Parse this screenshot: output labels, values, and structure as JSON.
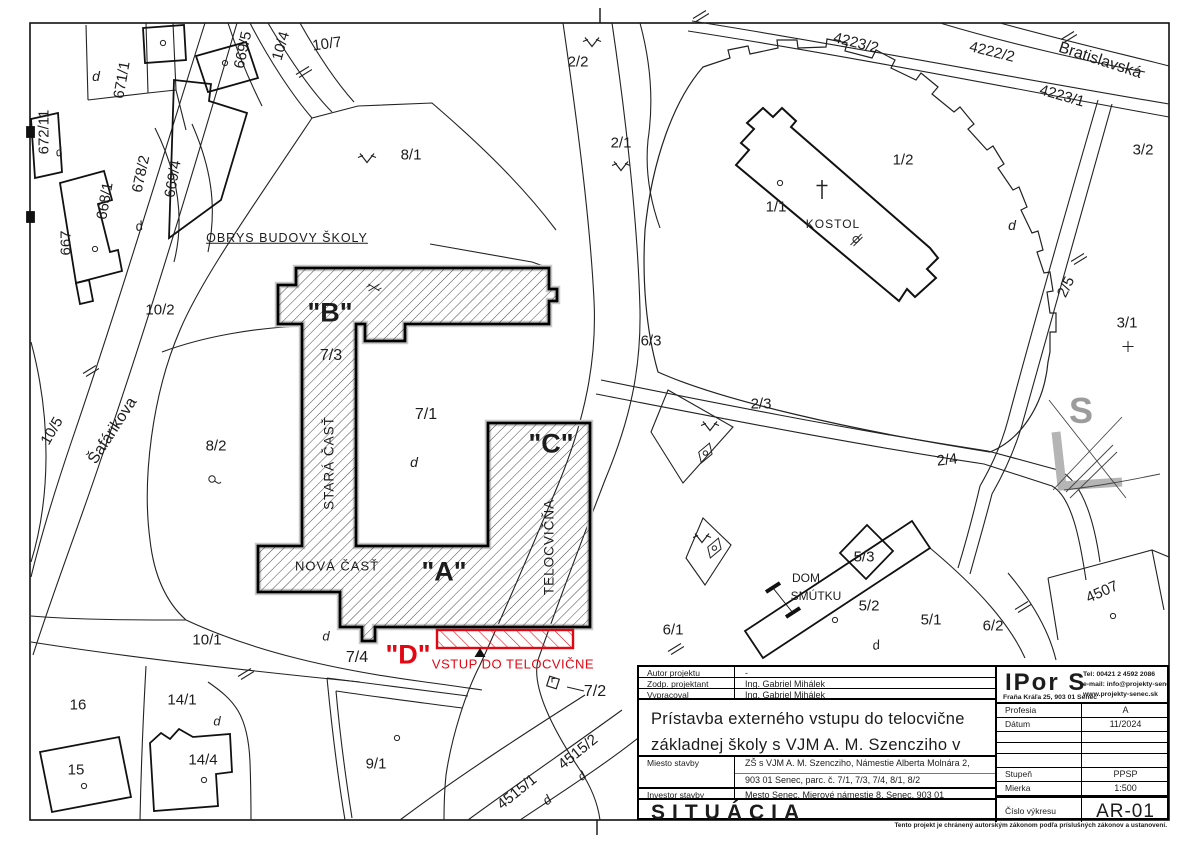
{
  "colors": {
    "accent_red": "#e30613",
    "north_gray": "#9c9c9c",
    "line": "#1c1c1c"
  },
  "map": {
    "labels": [
      {
        "t": "669/5",
        "x": 243,
        "y": 50,
        "r": -78
      },
      {
        "t": "10/4",
        "x": 281,
        "y": 46,
        "r": -74
      },
      {
        "t": "10/7",
        "x": 327,
        "y": 44,
        "r": -8
      },
      {
        "t": "671/1",
        "x": 122,
        "y": 80,
        "r": -80
      },
      {
        "t": "d",
        "x": 96,
        "y": 76,
        "i": 1,
        "s": 14
      },
      {
        "t": "672/11",
        "x": 44,
        "y": 132,
        "r": -90
      },
      {
        "t": "d",
        "x": 59,
        "y": 152,
        "i": 1,
        "s": 12,
        "r": -15
      },
      {
        "t": "678/2",
        "x": 141,
        "y": 174,
        "r": -78
      },
      {
        "t": "669/4",
        "x": 173,
        "y": 179,
        "r": -80
      },
      {
        "t": "668/1",
        "x": 105,
        "y": 201,
        "r": -80
      },
      {
        "t": "667",
        "x": 66,
        "y": 243,
        "r": -90
      },
      {
        "t": "d",
        "x": 139,
        "y": 226,
        "r": -15,
        "i": 1,
        "s": 13
      },
      {
        "t": "OBRYS BUDOVY ŠKOLY",
        "x": 287,
        "y": 238,
        "s": 12.5,
        "u": 1,
        "ls": 1,
        "n": "school-outline-callout"
      },
      {
        "t": "8/1",
        "x": 411,
        "y": 155
      },
      {
        "t": "2/2",
        "x": 578,
        "y": 62
      },
      {
        "t": "2/1",
        "x": 621,
        "y": 143
      },
      {
        "t": "1/1",
        "x": 776,
        "y": 207
      },
      {
        "t": "KOSTOL",
        "x": 833,
        "y": 224,
        "s": 12,
        "ls": 1,
        "n": "church-label"
      },
      {
        "t": "1/2",
        "x": 903,
        "y": 160
      },
      {
        "t": "4223/2",
        "x": 856,
        "y": 43,
        "r": 14
      },
      {
        "t": "4222/2",
        "x": 992,
        "y": 52,
        "r": 14
      },
      {
        "t": "Bratislavská",
        "x": 1100,
        "y": 61,
        "r": 18,
        "s": 16,
        "n": "street-bratislavska"
      },
      {
        "t": "4223/1",
        "x": 1062,
        "y": 96,
        "r": 16
      },
      {
        "t": "3/2",
        "x": 1143,
        "y": 150
      },
      {
        "t": "2/5",
        "x": 1066,
        "y": 287,
        "r": -64
      },
      {
        "t": "3/1",
        "x": 1127,
        "y": 323
      },
      {
        "t": "10/2",
        "x": 160,
        "y": 310
      },
      {
        "t": "Šafárikova",
        "x": 113,
        "y": 431,
        "r": -57,
        "s": 16,
        "n": "street-safarikova"
      },
      {
        "t": "10/5",
        "x": 52,
        "y": 431,
        "r": -60
      },
      {
        "t": "8/2",
        "x": 216,
        "y": 446
      },
      {
        "t": "\"B\"",
        "x": 330,
        "y": 313,
        "s": 27,
        "w": 1,
        "n": "building-b-label"
      },
      {
        "t": "7/3",
        "x": 331,
        "y": 356,
        "s": 16
      },
      {
        "t": "STARÁ ČASŤ",
        "x": 329,
        "y": 463,
        "r": -90,
        "s": 13.5,
        "ls": 1,
        "n": "old-wing-label"
      },
      {
        "t": "7/1",
        "x": 426,
        "y": 415,
        "s": 16
      },
      {
        "t": "d",
        "x": 414,
        "y": 462,
        "i": 1,
        "s": 14
      },
      {
        "t": "\"C\"",
        "x": 551,
        "y": 444,
        "s": 27,
        "w": 1,
        "n": "building-c-label"
      },
      {
        "t": "TELOCVIČŇA",
        "x": 549,
        "y": 547,
        "r": -90,
        "s": 13.5,
        "ls": 1,
        "n": "gym-label"
      },
      {
        "t": "NOVÁ ČASŤ",
        "x": 337,
        "y": 566,
        "s": 13,
        "ls": 1,
        "n": "new-wing-label"
      },
      {
        "t": "\"A\"",
        "x": 444,
        "y": 572,
        "s": 27,
        "w": 1,
        "n": "building-a-label"
      },
      {
        "t": "6/3",
        "x": 651,
        "y": 341
      },
      {
        "t": "2/3",
        "x": 761,
        "y": 404
      },
      {
        "t": "2/4",
        "x": 947,
        "y": 460,
        "r": -7
      },
      {
        "t": "d",
        "x": 1012,
        "y": 225,
        "i": 1,
        "s": 14
      },
      {
        "t": "d",
        "x": 326,
        "y": 636,
        "i": 1,
        "s": 13
      },
      {
        "t": "7/4",
        "x": 357,
        "y": 658,
        "s": 16
      },
      {
        "t": "\"D\"",
        "x": 408,
        "y": 655,
        "s": 27,
        "w": 1,
        "c": "red",
        "n": "entrance-d-label"
      },
      {
        "t": "VSTUP DO TELOCVIČNE",
        "x": 513,
        "y": 664,
        "s": 13,
        "c": "red",
        "ls": 0.5,
        "n": "entrance-callout"
      },
      {
        "t": "6/1",
        "x": 673,
        "y": 630
      },
      {
        "t": "DOM",
        "x": 806,
        "y": 578,
        "s": 12,
        "n": "dom-smutku-label-1"
      },
      {
        "t": "SMÚTKU",
        "x": 816,
        "y": 596,
        "s": 12,
        "n": "dom-smutku-label-2"
      },
      {
        "t": "5/3",
        "x": 864,
        "y": 557
      },
      {
        "t": "5/2",
        "x": 869,
        "y": 606
      },
      {
        "t": "5/1",
        "x": 931,
        "y": 620
      },
      {
        "t": "6/2",
        "x": 993,
        "y": 626
      },
      {
        "t": "4507",
        "x": 1102,
        "y": 592,
        "r": -24
      },
      {
        "t": "d",
        "x": 876,
        "y": 645,
        "r": -10,
        "i": 1,
        "s": 13
      },
      {
        "t": "10/1",
        "x": 207,
        "y": 640
      },
      {
        "t": "16",
        "x": 78,
        "y": 705
      },
      {
        "t": "14/1",
        "x": 182,
        "y": 700
      },
      {
        "t": "d",
        "x": 217,
        "y": 721,
        "i": 1,
        "s": 13
      },
      {
        "t": "14/4",
        "x": 203,
        "y": 760
      },
      {
        "t": "15",
        "x": 76,
        "y": 770
      },
      {
        "t": "9/1",
        "x": 376,
        "y": 764
      },
      {
        "t": "4515/1",
        "x": 517,
        "y": 792,
        "r": -39
      },
      {
        "t": "4515/2",
        "x": 578,
        "y": 752,
        "r": -39
      },
      {
        "t": "7/2",
        "x": 595,
        "y": 692,
        "s": 16
      },
      {
        "t": "d",
        "x": 547,
        "y": 800,
        "r": -39,
        "i": 1,
        "s": 13
      },
      {
        "t": "d",
        "x": 582,
        "y": 776,
        "r": -39,
        "i": 1,
        "s": 12
      },
      {
        "t": "S",
        "x": 1081,
        "y": 411,
        "s": 36,
        "w": 1,
        "c": "gray",
        "n": "north-arrow-letter"
      }
    ],
    "symbols": [
      {
        "k": "grass",
        "x": 367,
        "y": 160
      },
      {
        "k": "grass",
        "x": 592,
        "y": 44
      },
      {
        "k": "grass",
        "x": 621,
        "y": 168
      },
      {
        "k": "grass",
        "x": 710,
        "y": 428
      },
      {
        "k": "grass",
        "x": 702,
        "y": 540
      },
      {
        "k": "fence",
        "x": 303,
        "y": 73
      },
      {
        "k": "fence",
        "x": 700,
        "y": 17
      },
      {
        "k": "fence",
        "x": 1068,
        "y": 38
      },
      {
        "k": "fence",
        "x": 90,
        "y": 372
      },
      {
        "k": "fence",
        "x": 675,
        "y": 650
      },
      {
        "k": "fence",
        "x": 1022,
        "y": 608
      },
      {
        "k": "fence",
        "x": 245,
        "y": 675
      },
      {
        "k": "fence",
        "x": 1078,
        "y": 260
      },
      {
        "k": "circle",
        "x": 163,
        "y": 43
      },
      {
        "k": "circle",
        "x": 225,
        "y": 63
      },
      {
        "k": "circle",
        "x": 780,
        "y": 183
      },
      {
        "k": "circle",
        "x": 84,
        "y": 786
      },
      {
        "k": "circle",
        "x": 204,
        "y": 780
      },
      {
        "k": "circle",
        "x": 397,
        "y": 738
      },
      {
        "k": "circle",
        "x": 835,
        "y": 620
      },
      {
        "k": "circle",
        "x": 95,
        "y": 249
      },
      {
        "k": "circle",
        "x": 1113,
        "y": 616
      },
      {
        "k": "circle_tail",
        "x": 215,
        "y": 483
      },
      {
        "k": "plus",
        "x": 1128,
        "y": 349
      },
      {
        "k": "cross",
        "x": 822,
        "y": 192,
        "n": "church-cross"
      },
      {
        "k": "gate",
        "x": 856,
        "y": 242
      },
      {
        "k": "bench",
        "x": 707,
        "y": 455,
        "r": -40
      },
      {
        "k": "bench",
        "x": 716,
        "y": 550,
        "r": -40
      },
      {
        "k": "flagbox",
        "x": 553,
        "y": 684
      },
      {
        "k": "triangle",
        "x": 480,
        "y": 653,
        "n": "entrance-marker"
      },
      {
        "k": "survey_x",
        "x": 374,
        "y": 290
      }
    ]
  },
  "title_block": {
    "rows": [
      {
        "label": "Autor projektu",
        "value": "-"
      },
      {
        "label": "Zodp. projektant",
        "value": "Ing. Gabriel Mihálek"
      },
      {
        "label": "Vypracoval",
        "value": "Ing. Gabriel Mihálek"
      }
    ],
    "project_title_line1": "Prístavba externého vstupu do telocvične",
    "project_title_line2": "základnej školy s VJM A. M. Szencziho v Senci",
    "miesto_label": "Miesto stavby",
    "miesto_value_line1": "ZŠ s VJM A. M. Szencziho, Námestie Alberta Molnára 2,",
    "miesto_value_line2": "903 01 Senec, parc. č. 7/1, 7/3, 7/4, 8/1, 8/2",
    "investor_label": "Investor stavby",
    "investor_value": "Mesto Senec, Mierové námestie 8, Senec, 903 01",
    "drawing_name": "SITUÁCIA",
    "company": {
      "logo": "IPor S",
      "address": "Fraňa Kráľa 25,  903 01 Senec",
      "tel": "Tel:  00421 2 4592 2086",
      "email": "e-mail: info@projekty-senec.sk",
      "web": "www.projekty-senec.sk"
    },
    "fields": [
      {
        "label": "Profesia",
        "value": "A"
      },
      {
        "label": "Dátum",
        "value": "11/2024"
      },
      {
        "label": "",
        "value": ""
      },
      {
        "label": "",
        "value": ""
      },
      {
        "label": "",
        "value": ""
      },
      {
        "label": "Stupeň",
        "value": "PPSP"
      },
      {
        "label": "Mierka",
        "value": "1:500"
      }
    ],
    "cislo_label": "Číslo výkresu",
    "cislo_value": "AR-01",
    "copyright": "Tento projekt je chránený autorským zákonom podľa príslušných zákonov a ustanovení."
  }
}
